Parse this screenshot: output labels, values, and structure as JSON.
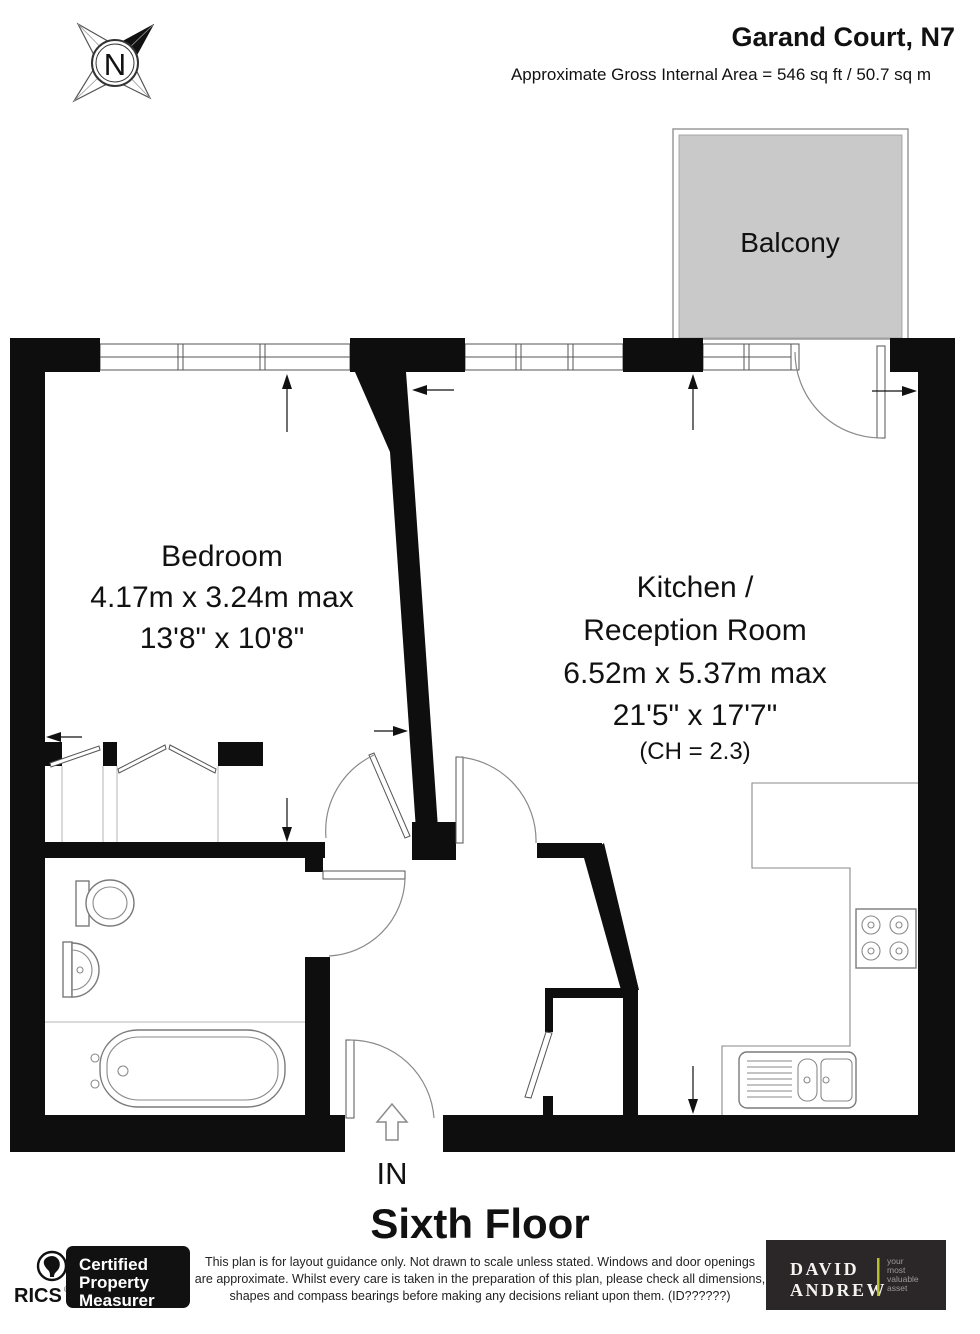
{
  "header": {
    "title": "Garand Court, N7",
    "area_line": "Approximate Gross Internal Area = 546 sq ft / 50.7 sq m"
  },
  "compass": {
    "label": "N"
  },
  "rooms": {
    "balcony": {
      "label": "Balcony"
    },
    "bedroom": {
      "label": "Bedroom",
      "dims_metric": "4.17m x 3.24m max",
      "dims_imperial": "13'8\" x 10'8\""
    },
    "kitchen": {
      "label_line1": "Kitchen /",
      "label_line2": "Reception Room",
      "dims_metric": "6.52m x 5.37m max",
      "dims_imperial": "21'5\" x 17'7\"",
      "ceiling_height": "(CH = 2.3)"
    }
  },
  "entrance": {
    "label": "IN"
  },
  "floor": {
    "title": "Sixth Floor"
  },
  "footer": {
    "rics": {
      "brand": "RICS",
      "registered_mark": "®",
      "badge": [
        "Certified",
        "Property",
        "Measurer"
      ]
    },
    "disclaimer": [
      "This plan is for layout guidance only. Not drawn to scale unless stated. Windows and door openings",
      "are approximate. Whilst every care is taken in the preparation of this plan, please check all dimensions,",
      "shapes and compass bearings before making any decisions reliant upon them. (ID??????)"
    ],
    "agency": {
      "name_line1": "DAVID",
      "name_line2": "ANDREW",
      "tagline": [
        "your",
        "most",
        "valuable",
        "asset"
      ]
    }
  },
  "colors": {
    "wall": "#0e0e0e",
    "balcony_fill": "#c9c9c9",
    "badge_bg": "#111111",
    "agency_bg": "#2b2627",
    "agency_accent": "#b8bf2e"
  }
}
